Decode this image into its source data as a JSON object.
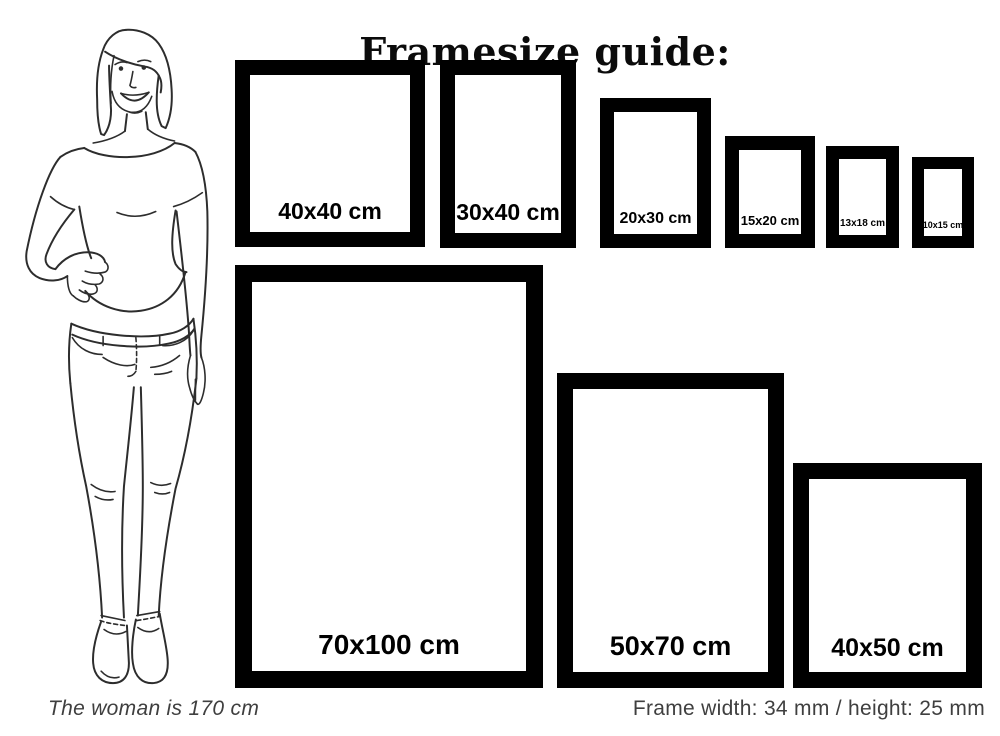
{
  "title": "Framesize guide:",
  "frames": [
    {
      "label": "40x40 cm",
      "width_cm": 40,
      "height_cm": 40
    },
    {
      "label": "30x40 cm",
      "width_cm": 30,
      "height_cm": 40
    },
    {
      "label": "20x30 cm",
      "width_cm": 20,
      "height_cm": 30
    },
    {
      "label": "15x20 cm",
      "width_cm": 15,
      "height_cm": 20
    },
    {
      "label": "13x18 cm",
      "width_cm": 13,
      "height_cm": 18
    },
    {
      "label": "10x15 cm",
      "width_cm": 10,
      "height_cm": 15
    },
    {
      "label": "70x100 cm",
      "width_cm": 70,
      "height_cm": 100
    },
    {
      "label": "50x70 cm",
      "width_cm": 50,
      "height_cm": 70
    },
    {
      "label": "40x50 cm",
      "width_cm": 40,
      "height_cm": 50
    }
  ],
  "captions": {
    "woman_note": "The woman is 170 cm",
    "frame_spec": "Frame width: 34 mm / height: 25 mm"
  },
  "colors": {
    "frame": "#000000",
    "caption_text": "#3f3f3f",
    "line_art": "#2d2d2d",
    "background": "#ffffff"
  }
}
